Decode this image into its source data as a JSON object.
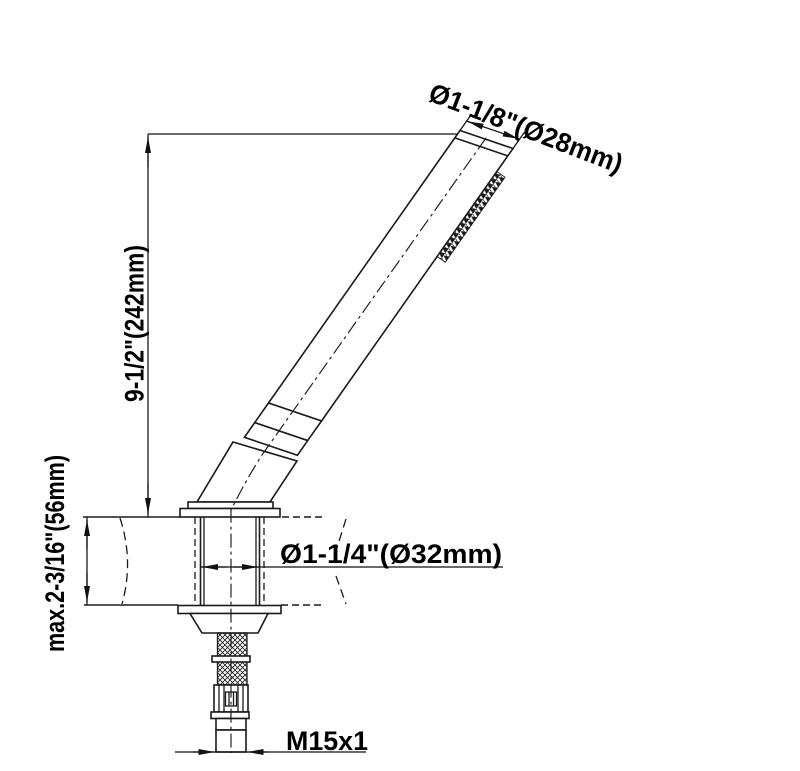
{
  "labels": {
    "head_diameter": "Ø1-1/8\"(Ø28mm)",
    "height": "9-1/2\"(242mm)",
    "max_mounting_thickness": "max.2-3/16\"(56mm)",
    "deck_hole_diameter": "Ø1-1/4\"(Ø32mm)",
    "connection_thread": "M15x1"
  },
  "colors": {
    "line": "#1a1a1a",
    "text": "#000000",
    "background": "#ffffff"
  }
}
